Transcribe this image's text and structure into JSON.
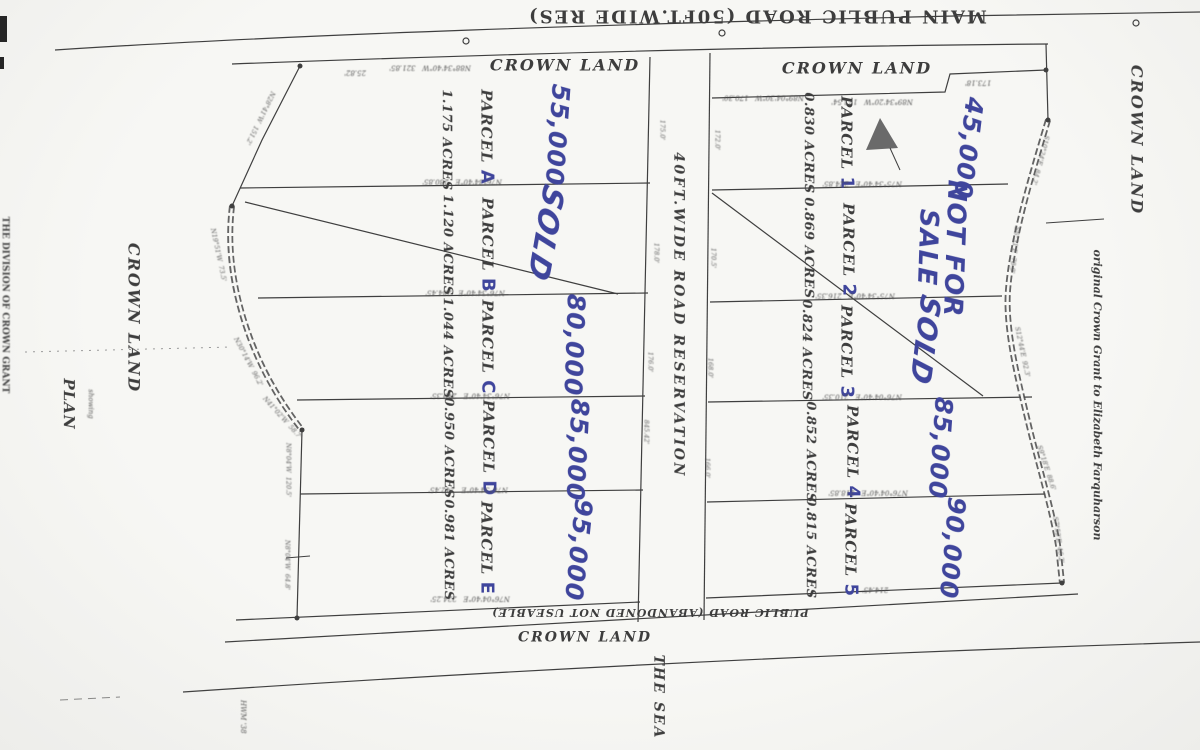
{
  "labels": {
    "main_road": "MAIN PUBLIC ROAD (50FT.WIDE RES)",
    "crown_land_top_left": "CROWN LAND",
    "crown_land_top_right": "CROWN LAND",
    "crown_land_left": "CROWN LAND",
    "crown_land_right": "CROWN LAND",
    "crown_land_bottom": "CROWN LAND",
    "road_reservation": "40FT.WIDE ROAD RESERVATION",
    "abandoned_road": "PUBLIC ROAD (ABANDONED NOT USEABLE)",
    "the_sea": "THE SEA",
    "plan": "PLAN",
    "plan_sub": "showing",
    "original_grant": "original Crown Grant to Elizabeth Farquharson",
    "left_margin_note": "THE DIVISION OF CROWN GRANT",
    "hwm": "HWM '38"
  },
  "parcels_left": [
    {
      "label": "PARCEL ",
      "designator": "A",
      "acres": "1.175 ACRES",
      "note": "55,000"
    },
    {
      "label": "PARCEL ",
      "designator": "B",
      "acres": "1.120 ACRES",
      "note": "SOLD"
    },
    {
      "label": "PARCEL ",
      "designator": "C",
      "acres": "1.044 ACRES",
      "note": "80,000"
    },
    {
      "label": "PARCEL ",
      "designator": "D",
      "acres": "0.950 ACRES",
      "note": "85,000"
    },
    {
      "label": "PARCEL ",
      "designator": "E",
      "acres": "0.981 ACRES",
      "note": "95,000"
    }
  ],
  "parcels_right": [
    {
      "label": "PARCEL ",
      "designator": "1",
      "acres": "0.830 ACRES",
      "note": "45,000"
    },
    {
      "label": "PARCEL ",
      "designator": "2",
      "acres": "0.869 ACRES",
      "note_line1": "NOT FOR",
      "note_line2": "SALE"
    },
    {
      "label": "PARCEL ",
      "designator": "3",
      "acres": "0.824 ACRES",
      "note": "SOLD"
    },
    {
      "label": "PARCEL ",
      "designator": "4",
      "acres": "0.852 ACRES",
      "note": "85,000"
    },
    {
      "label": "PARCEL ",
      "designator": "5",
      "acres": "0.815 ACRES",
      "note": "90,000"
    }
  ],
  "dims_left": [
    "N76°34'40\"E   280.85'",
    "N76°34'40\"E   284.45'",
    "N76°34'40\"E   249.35'",
    "N76°34'40\"E   242.45'",
    "N76°04'40\"E   224.25'"
  ],
  "dims_right": [
    "N75°34'40\"E   224.85'",
    "N75°34'40\"E   216.35'",
    "N76°04'40\"E   210.35'",
    "N76°04'40\"E   218.85'",
    "214.45'"
  ],
  "top_dims": [
    "N88°34'40\"W   321.85'",
    "25.82'",
    "N89°04'30\"W   170.30'",
    "N89°34'20\"W   173.54'",
    "173.18'"
  ],
  "road_dims_left": [
    "175.0'",
    "178.0'",
    "176.0'",
    "845.42'"
  ],
  "road_dims_right": [
    "172.0'",
    "170.5'",
    "168.0'",
    "166.0'"
  ],
  "chain_dims_left": [
    "N19°51'W  73.5'",
    "N30°14'W  96.2'",
    "N41°02'W  58.7'"
  ],
  "chain_dims_right": [
    "S10°24'E  84.2'",
    "S6°31'E  78.9'",
    "S12°44'E  92.3'",
    "S9°18'E  88.6'",
    "S7°52'E  46.2'"
  ],
  "edge_dims": [
    "N28°41'W  151.2'",
    "N8°04'W  120.5'",
    "N8°04'W  64.8'"
  ],
  "colors": {
    "ink": "#3d3d3d",
    "handwriting": "#3f459c",
    "paper": "#f7f7f4"
  }
}
